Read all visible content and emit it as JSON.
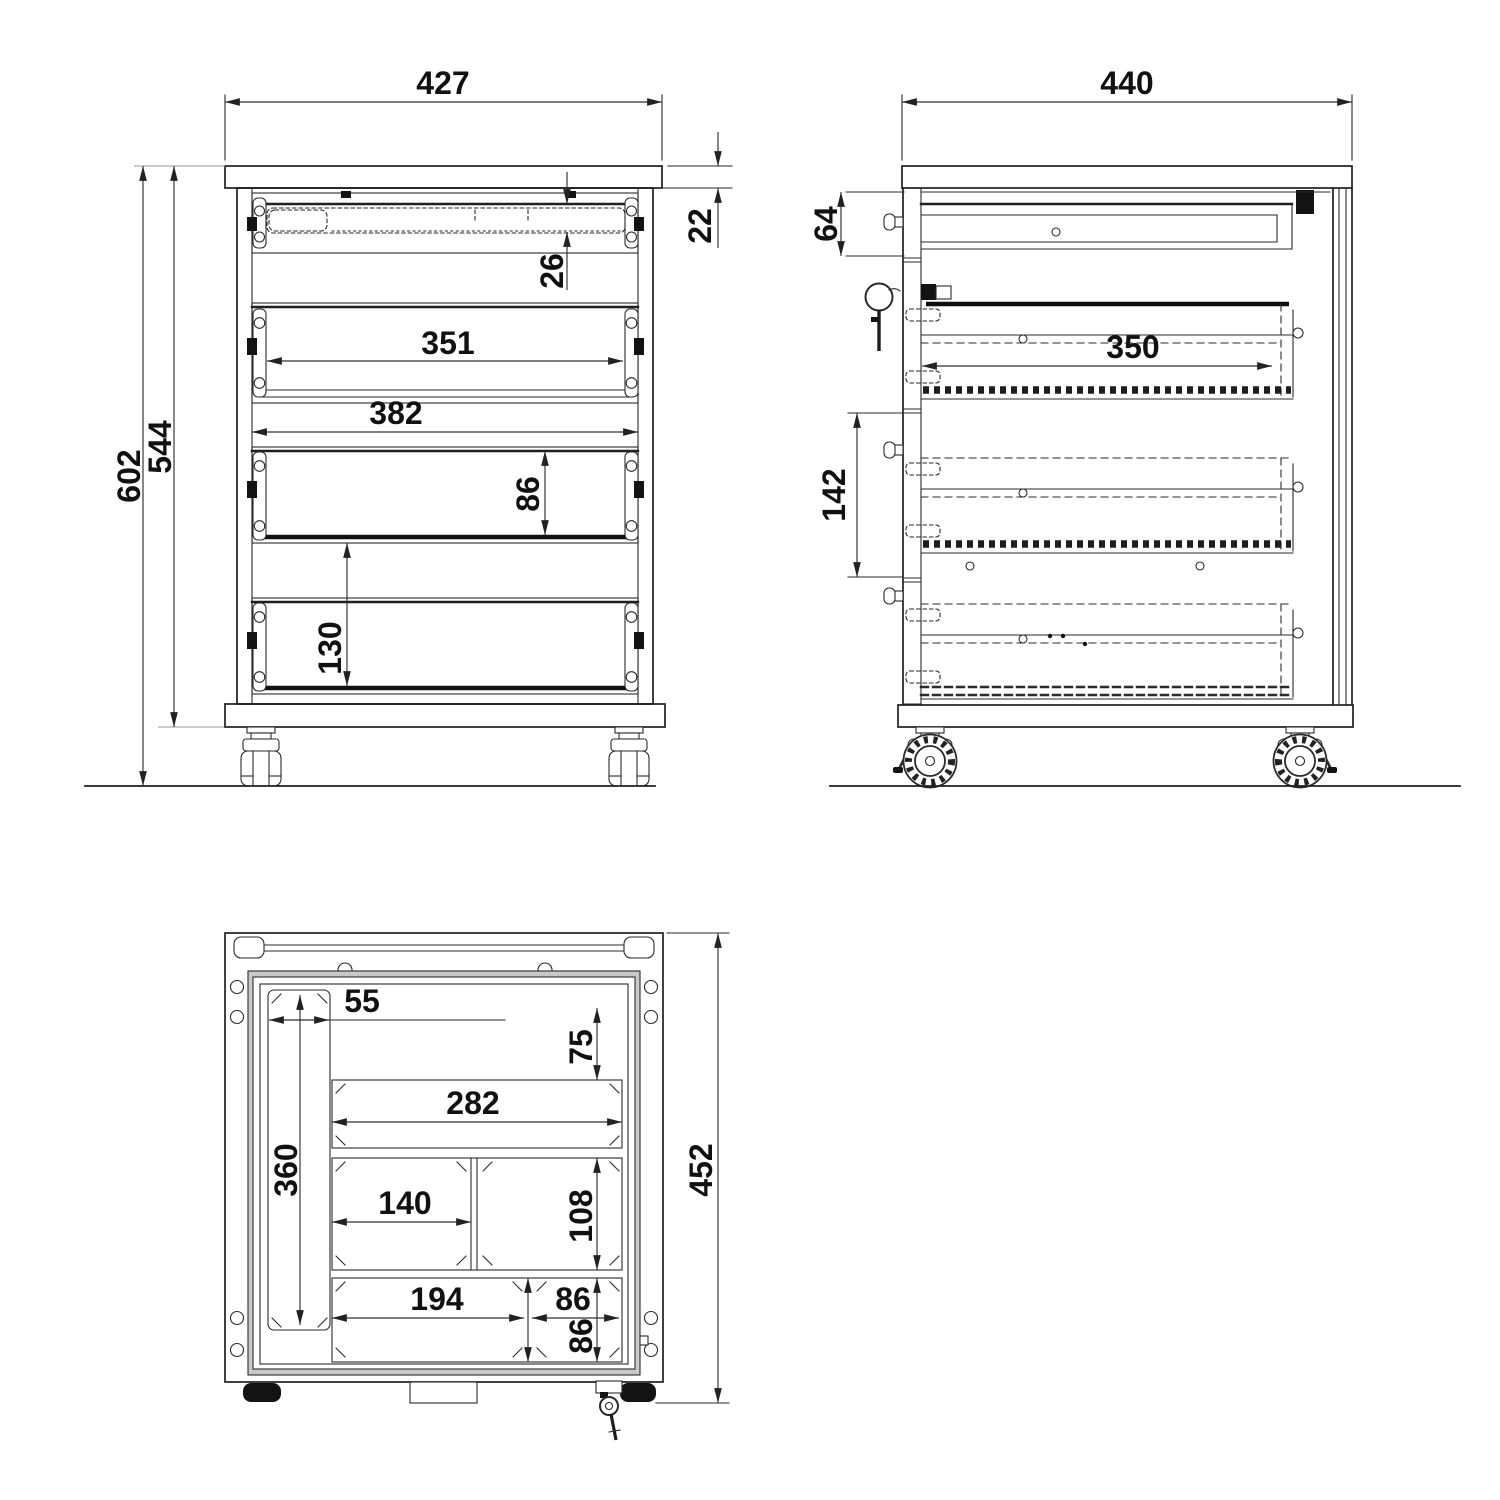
{
  "drawing": {
    "units": "mm",
    "views": {
      "front": {
        "overall_width": "427",
        "top_panel_thickness": "22",
        "pen_tray_depth": "26",
        "drawer_front_width": "351",
        "opening_width": "382",
        "drawer_front_height": "86",
        "drawer_pitch": "130",
        "overall_height": "602",
        "carcass_height": "544"
      },
      "side": {
        "overall_depth": "440",
        "top_drawer_height": "64",
        "drawer_depth": "350",
        "compartment_height": "142"
      },
      "top": {
        "slot_width": "55",
        "slot_length": "360",
        "front_margin": "75",
        "large_compartment_width": "282",
        "mid_compartment_width": "140",
        "mid_compartment_depth": "108",
        "lower_compartment_width": "194",
        "small_compartment_width": "86",
        "small_compartment_depth": "86",
        "overall_depth": "452"
      }
    }
  }
}
